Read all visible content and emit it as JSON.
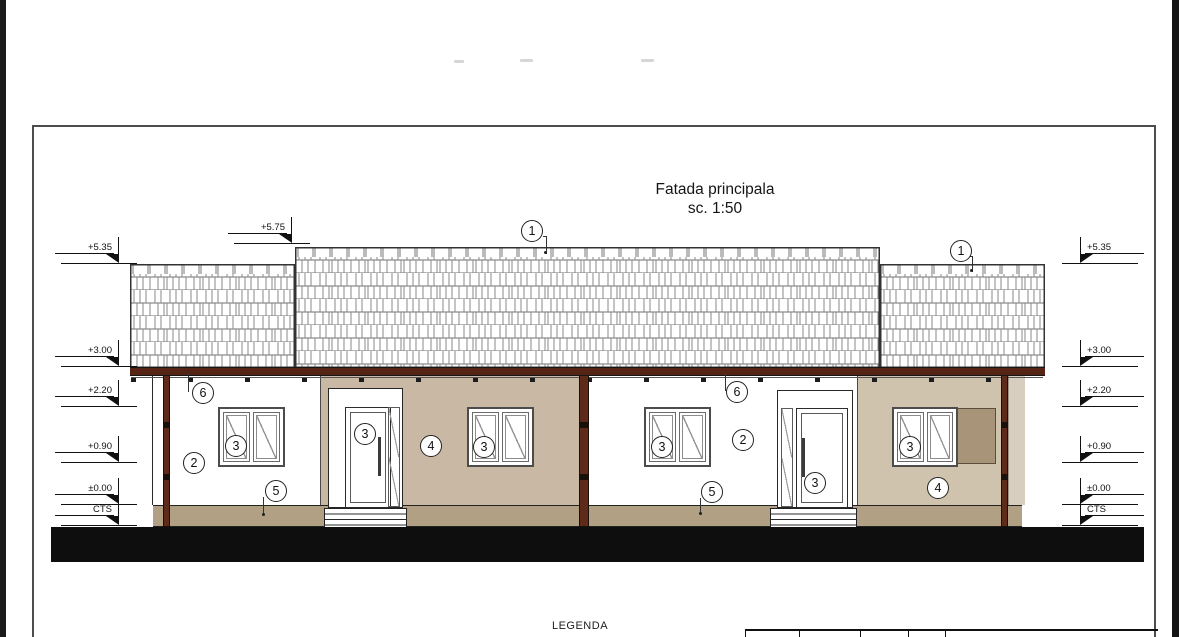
{
  "title": {
    "line1": "Fatada principala",
    "line2": "sc. 1:50"
  },
  "legend": {
    "label": "LEGENDA"
  },
  "levels": {
    "left": [
      "+5.35",
      "+3.00",
      "+2.20",
      "+0.90",
      "±0.00",
      "CTS"
    ],
    "right": [
      "+5.35",
      "+3.00",
      "+2.20",
      "+0.90",
      "±0.00",
      "CTS"
    ],
    "ridge": "+5.75"
  },
  "callouts": {
    "n1": "1",
    "n2": "2",
    "n3": "3",
    "n4": "4",
    "n5": "5",
    "n6": "6"
  },
  "colors": {
    "wall_beige": "#c9b9a4",
    "wall_beige_light": "#d0c3ae",
    "corner_strip": "#d8cec0",
    "plinth": "#b2a084",
    "fascia_maroon": "#552415",
    "window_box_brown": "#a89478",
    "ground_black": "#0e0e0e"
  }
}
